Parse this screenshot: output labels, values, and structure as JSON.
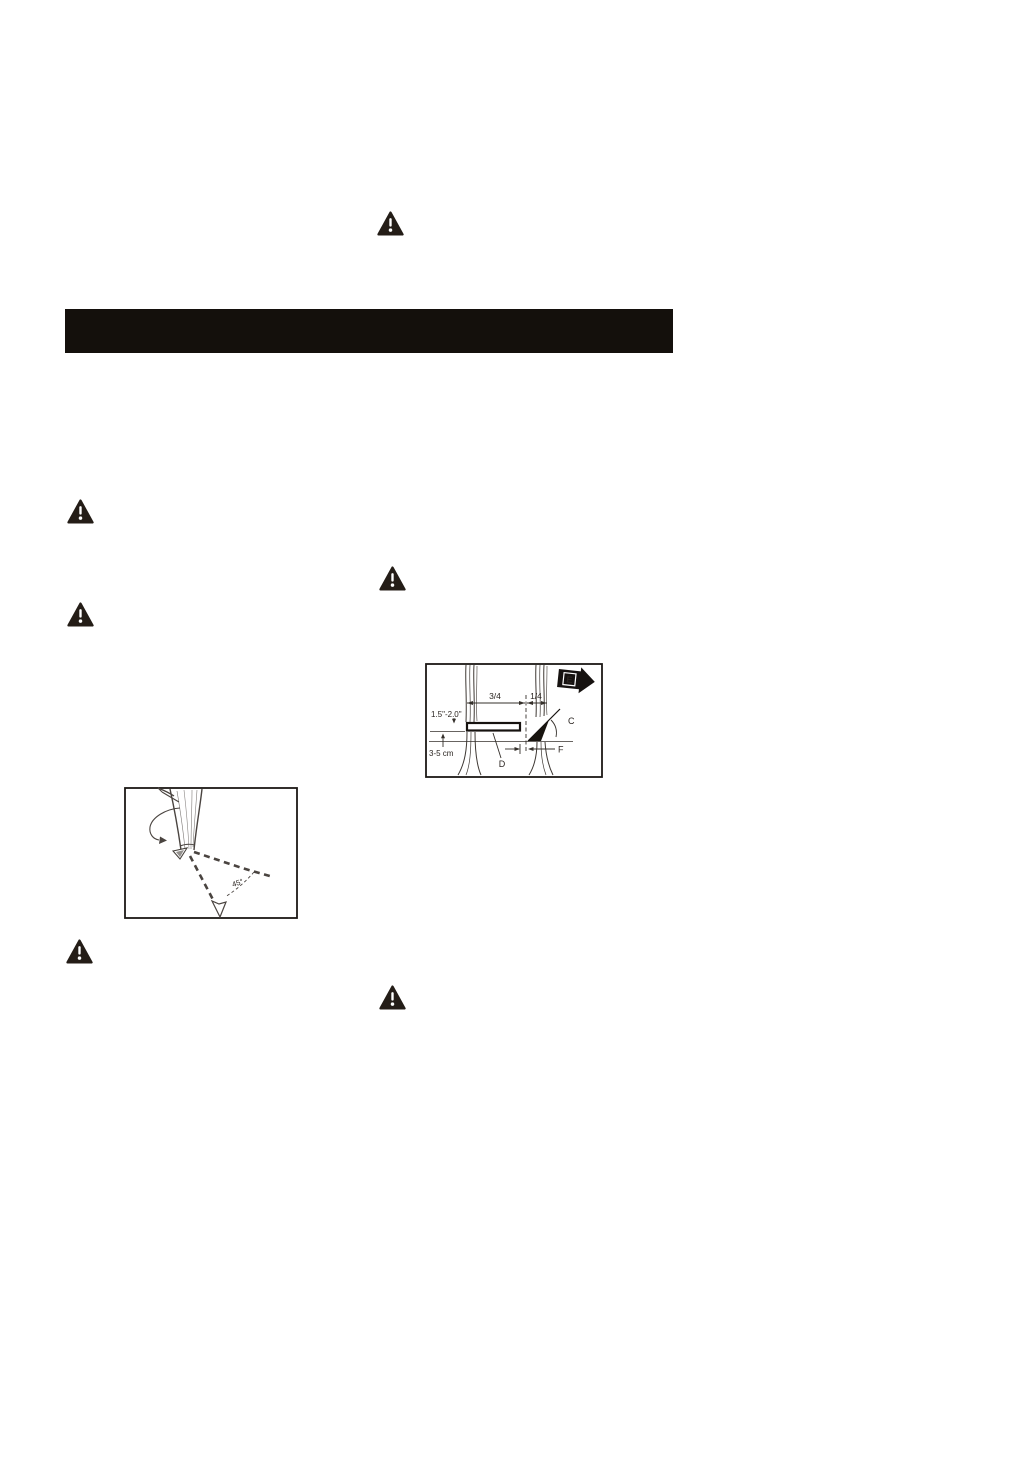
{
  "page": {
    "background": "#ffffff",
    "ink": "#221c18",
    "sketch_line": "#45403b"
  },
  "header_bar": {
    "text": ""
  },
  "icons": {
    "warning": "warning-triangle"
  },
  "figures": {
    "direction": {
      "angle_label": "45°"
    },
    "cuts": {
      "ratio_left": "3/4",
      "ratio_right": "1/4",
      "cut_height": "1.5\"-2.0\"",
      "stump_height": "3-5 cm",
      "notch_angle": "C",
      "felling_cut": "D",
      "fall_direction": "E",
      "hinge_width": "F"
    }
  }
}
